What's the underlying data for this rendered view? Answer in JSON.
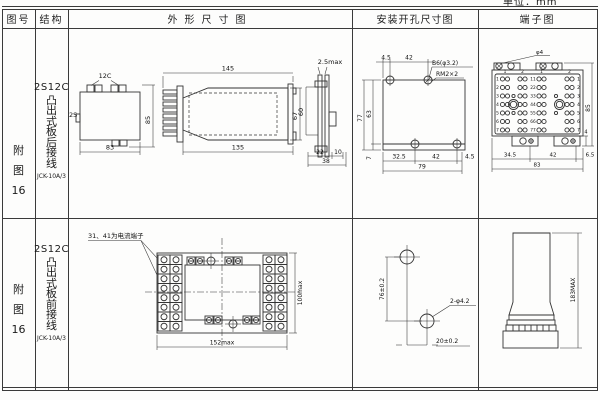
{
  "page": {
    "unit_label": "单位：mm"
  },
  "header": {
    "col_fig": "图号",
    "col_structure": "结构",
    "col_outline": "外形尺寸图",
    "col_mounting": "安装开孔尺寸图",
    "col_terminal": "端子图"
  },
  "rows": [
    {
      "fig_label": "附图16",
      "structure": {
        "model": "2S12C",
        "type": "凸出式板后接线",
        "code": "JCK-10A/3"
      },
      "outline": {
        "top_view": {
          "label_top": "12C",
          "label_left": "2S",
          "dim_width": "83",
          "dim_height": "85"
        },
        "side_view": {
          "dim_top": "145",
          "dim_bottom": "135",
          "dim_height": "67"
        },
        "panel_view": {
          "dim_top": "2.5max",
          "dim_depth": "60",
          "dim_b1": "22",
          "dim_b2": "10",
          "dim_b3": "38"
        }
      },
      "mounting": {
        "dim_t1": "4.5",
        "dim_t2": "42",
        "label_hole": "B6(φ3.2)",
        "label_thread": "RM2×2",
        "dim_l1": "77",
        "dim_l2": "63",
        "dim_b0": "7",
        "dim_b1": "32.5",
        "dim_b2": "42",
        "dim_b3": "4.5",
        "dim_total": "79"
      },
      "terminal": {
        "label_top": "φ4",
        "dim_height": "85",
        "dim_small": "4",
        "dim_b1": "34.5",
        "dim_b2": "42",
        "dim_b3": "6.5",
        "dim_total": "83",
        "row_nums": [
          "1",
          "2",
          "3",
          "4",
          "5",
          "6",
          "7"
        ],
        "pair_nums": [
          "11",
          "22",
          "33",
          "44",
          "55",
          "66",
          "77"
        ],
        "col_nums": [
          "1",
          "2",
          "1",
          "2"
        ]
      }
    },
    {
      "fig_label": "附图16",
      "structure": {
        "model": "2S12C",
        "type": "凸出式板前接线",
        "code": "JCK-10A/3"
      },
      "outline": {
        "note": "31、41为电流端子",
        "dim_width": "152max",
        "dim_height": "100max"
      },
      "mounting": {
        "dim_v": "76±0.2",
        "dim_h": "20±0.2",
        "label_hole": "2-φ4.2"
      },
      "terminal": {
        "dim_height": "183MAX"
      }
    }
  ]
}
